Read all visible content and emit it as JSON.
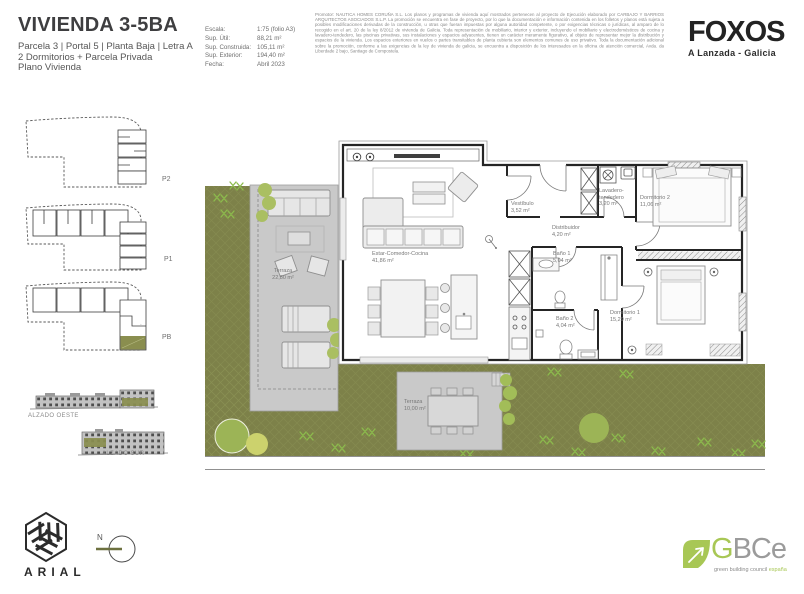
{
  "header": {
    "title": "VIVIENDA 3-5BA",
    "subtitle_lines": [
      "Parcela 3 | Portal 5 | Planta Baja | Letra A",
      "2 Dormitorios + Parcela Privada",
      "Plano Vivienda"
    ],
    "specs": [
      {
        "label": "Escala:",
        "value": "1:75 (folio A3)"
      },
      {
        "label": "Sup. Útil:",
        "value": "88,21 m²"
      },
      {
        "label": "Sup. Construida:",
        "value": "105,11 m²"
      },
      {
        "label": "Sup. Exterior:",
        "value": "194,40 m²"
      },
      {
        "label": "Fecha:",
        "value": "Abril 2023"
      }
    ],
    "legal_text": "Promotor: NAUTICA HOMES CORUÑA S.L. Los planos y programas de vivienda aquí mostrados pertenecen al proyecto de Ejecución elaborado por CARBAJO Y BARRIOS ARQUITECTOS ASOCIADOS S.L.P. La promoción se encuentra en fase de proyecto, por lo que la documentación e información contenida en los folletos y planos está sujeta a posibles modificaciones derivadas de la construcción, u otras que fueran impuestas por alguna autoridad competente, o por exigencias técnicas o jurídicas, al amparo de lo recogido en el art. 20 de la ley 8/2012 de vivienda de Galicia. Toda representación de mobiliario, interior y exterior, incluyendo el mobiliario y electrodomésticos de cocina y lavadero-tendedero, las piscinas privativas, sus instalaciones y espacios adyacentes, tienen un carácter meramente figurativo, al objeto de representar mejor la distribución y espacios de la vivienda. Los espacios exteriores en vuelos o partes transitables de planta cubierta son elementos comunes de uso privativo. Toda la documentación adicional sobre la promoción, conforme a las exigencias de la ley de vivienda de galicia, se encuentra a disposición de los interesados en la oficina de atención comercial, Avda. da Liberdade 2 bajo, Santiago de Compostela.",
    "brand": {
      "name": "FOXOS",
      "location": "A Lanzada - Galicia"
    }
  },
  "sidebar": {
    "key_plans": [
      {
        "label": "P2"
      },
      {
        "label": "P1"
      },
      {
        "label": "PB"
      }
    ],
    "elevations": [
      {
        "label": "ALZADO OESTE"
      },
      {
        "label": "ALZADO SUR"
      }
    ]
  },
  "plan": {
    "rooms": [
      {
        "name": "Terraza",
        "area": "22,80 m²"
      },
      {
        "name": "Estar-Comedor-Cocina",
        "area": "41,86 m²"
      },
      {
        "name": "Vestíbulo",
        "area": "3,52 m²"
      },
      {
        "name": "Lavadero-tendedero",
        "area": "3,20 m²"
      },
      {
        "name": "Dormitorio 2",
        "area": "11,06 m²"
      },
      {
        "name": "Distribuidor",
        "area": "4,20 m²"
      },
      {
        "name": "Baño 1",
        "area": "5,04 m²"
      },
      {
        "name": "Baño 2",
        "area": "4,04 m²"
      },
      {
        "name": "Dormitorio 1",
        "area": "15,29 m²"
      },
      {
        "name": "Terraza",
        "area": "10,00 m²"
      }
    ]
  },
  "footer": {
    "studio_name": "ARIAL",
    "north_label": "N",
    "cert": {
      "g": "G",
      "bce": "BCe",
      "tagline_gray": "green building council ",
      "tagline_green": "españa"
    }
  },
  "colors": {
    "garden_olive": "#7d8149",
    "bush_green": "#a2bd58",
    "bush_yellow": "#ccd26d",
    "highlight_olive": "#8a8e4f",
    "terrace_gray": "#c9c9c9",
    "wall_dark": "#252525",
    "brand_dark": "#232323",
    "gbce_green": "#a8c755"
  }
}
